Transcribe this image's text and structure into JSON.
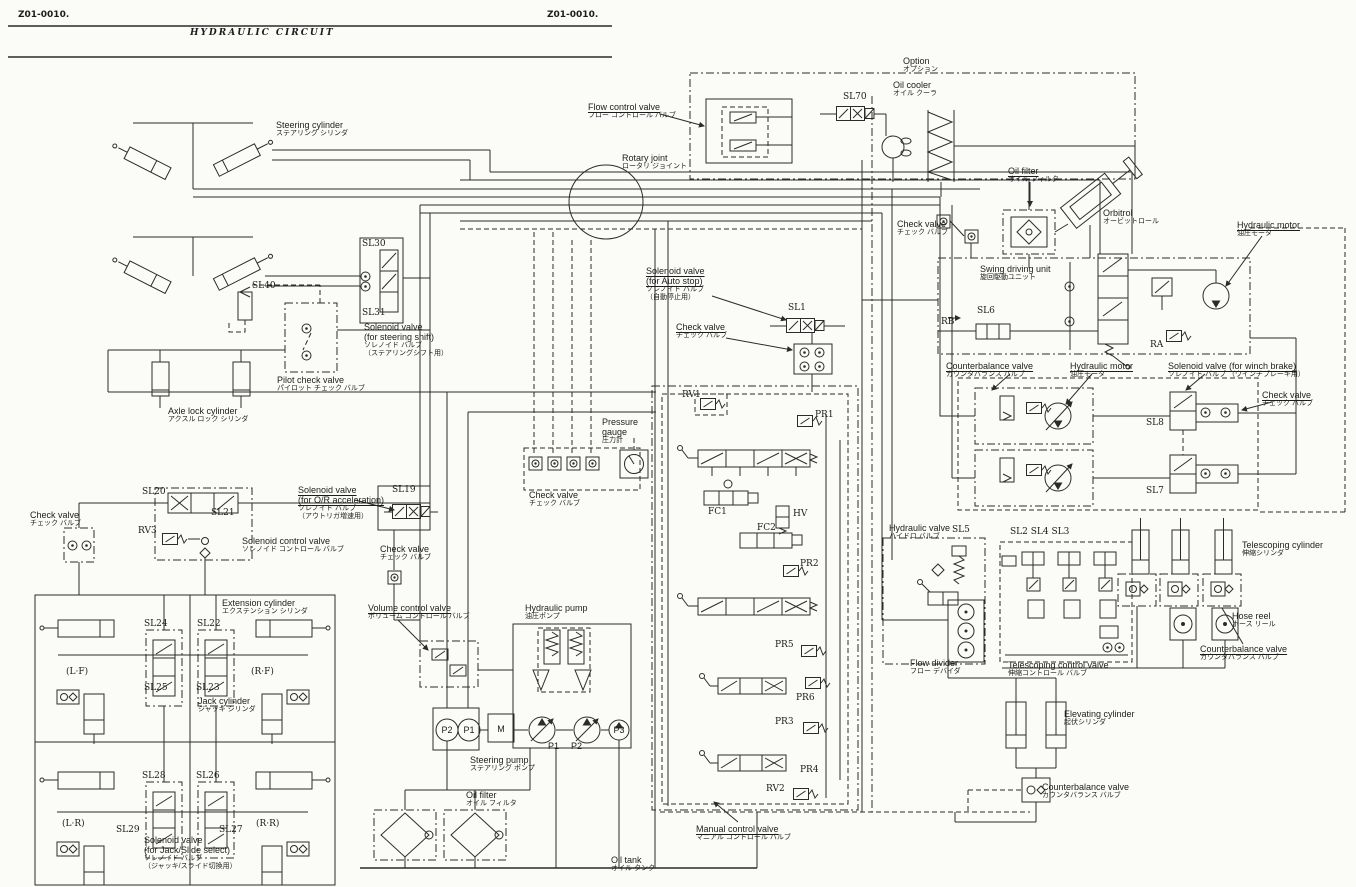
{
  "diagram": {
    "title": "HYDRAULIC  CIRCUIT",
    "doc_code": "Z01-0010."
  },
  "ink_color": "#2b2b2b",
  "paper_color": "#fbfbf8",
  "labels": [
    {
      "id": "doc-no-left",
      "en": "Z01-0010.",
      "x": 18,
      "y": 10,
      "cls": "docno"
    },
    {
      "id": "doc-no-right",
      "en": "Z01-0010.",
      "x": 547,
      "y": 10,
      "cls": "docno"
    },
    {
      "id": "page-title",
      "en": "HYDRAULIC  CIRCUIT",
      "x": 190,
      "y": 28,
      "cls": "title"
    },
    {
      "id": "steering-cylinder-label",
      "en": "Steering cylinder",
      "jp": "ステアリング シリンダ",
      "x": 276,
      "y": 120
    },
    {
      "id": "flow-control-valve-label",
      "en": "Flow control valve",
      "jp": "フロー コントロール バルブ",
      "x": 588,
      "y": 102,
      "u": 1
    },
    {
      "id": "rotary-joint-label",
      "en": "Rotary joint",
      "jp": "ロータリ ジョイント",
      "x": 622,
      "y": 153
    },
    {
      "id": "option-label",
      "en": "Option",
      "jp": "オプション",
      "x": 903,
      "y": 56
    },
    {
      "id": "oil-cooler-label",
      "en": "Oil cooler",
      "jp": "オイル クーラ",
      "x": 893,
      "y": 80
    },
    {
      "id": "sl70-label",
      "en": "SL70",
      "x": 843,
      "y": 92,
      "cls": "code"
    },
    {
      "id": "oil-filter-top-label",
      "en": "Oil filter",
      "jp": "オイル フィルタ",
      "x": 1008,
      "y": 166,
      "u": 1
    },
    {
      "id": "orbitrol-label",
      "en": "Orbitrol",
      "jp": "オービットロール",
      "x": 1103,
      "y": 208
    },
    {
      "id": "hydraulic-motor-top-label",
      "en": "Hydraulic motor",
      "jp": "油圧モータ",
      "x": 1237,
      "y": 220,
      "u": 1
    },
    {
      "id": "check-valve-top-label",
      "en": "Check valve",
      "jp": "チェック バルブ",
      "x": 897,
      "y": 219
    },
    {
      "id": "swing-driving-unit-label",
      "en": "Swing driving unit",
      "jp": "旋回駆動ユニット",
      "x": 980,
      "y": 264
    },
    {
      "id": "rb-label",
      "en": "RB",
      "x": 941,
      "y": 317,
      "cls": "code sm"
    },
    {
      "id": "sl6-label",
      "en": "SL6",
      "x": 977,
      "y": 306,
      "cls": "code"
    },
    {
      "id": "ra-label",
      "en": "RA",
      "x": 1150,
      "y": 340,
      "cls": "code sm"
    },
    {
      "id": "solenoid-auto-stop-label",
      "en": "Solenoid valve\n(for Auto stop)",
      "jp": "ソレノイド バルブ\n（自動停止用）",
      "x": 646,
      "y": 266,
      "u": 1
    },
    {
      "id": "check-valve-mid-label",
      "en": "Check valve",
      "jp": "チェック バルブ",
      "x": 676,
      "y": 322,
      "u": 1
    },
    {
      "id": "sl1-label",
      "en": "SL1",
      "x": 788,
      "y": 303,
      "cls": "code"
    },
    {
      "id": "counterbalance-top-label",
      "en": "Counterbalance valve",
      "jp": "カウンタバランス バルブ",
      "x": 946,
      "y": 361,
      "u": 1
    },
    {
      "id": "hydraulic-motor-mid-label",
      "en": "Hydraulic motor",
      "jp": "油圧モータ",
      "x": 1070,
      "y": 361,
      "u": 1
    },
    {
      "id": "solenoid-winch-label",
      "en": "Solenoid valve (for winch brake)",
      "jp": "ソレノイド バルブ （ウインチブレーキ用）",
      "x": 1168,
      "y": 361,
      "u": 1
    },
    {
      "id": "check-valve-right-label",
      "en": "Check valve",
      "jp": "チェック バルブ",
      "x": 1262,
      "y": 390,
      "u": 1
    },
    {
      "id": "sl8-label",
      "en": "SL8",
      "x": 1146,
      "y": 418,
      "cls": "code lg"
    },
    {
      "id": "sl7-label",
      "en": "SL7",
      "x": 1146,
      "y": 486,
      "cls": "code lg"
    },
    {
      "id": "sl30-label",
      "en": "SL30",
      "x": 362,
      "y": 239,
      "cls": "code"
    },
    {
      "id": "sl31-label",
      "en": "SL31",
      "x": 362,
      "y": 308,
      "cls": "code"
    },
    {
      "id": "solenoid-steering-shift-label",
      "en": "Solenoid valve\n(for steering shift)",
      "jp": "ソレノイド バルブ\n（ステアリングシフト用）",
      "x": 364,
      "y": 322
    },
    {
      "id": "sl40-label",
      "en": "SL40",
      "x": 252,
      "y": 281,
      "cls": "code"
    },
    {
      "id": "pilot-check-valve-label",
      "en": "Pilot check valve",
      "jp": "パイロット チェック バルブ",
      "x": 277,
      "y": 375
    },
    {
      "id": "axle-lock-cylinder-label",
      "en": "Axle lock cylinder",
      "jp": "アクスル ロック シリンダ",
      "x": 168,
      "y": 406
    },
    {
      "id": "check-valve-left-label",
      "en": "Check valve",
      "jp": "チェック バルブ",
      "x": 30,
      "y": 510
    },
    {
      "id": "sl20-label",
      "en": "SL20",
      "x": 142,
      "y": 487,
      "cls": "code"
    },
    {
      "id": "sl21-label",
      "en": "SL21",
      "x": 211,
      "y": 508,
      "cls": "code"
    },
    {
      "id": "rv3-label",
      "en": "RV3",
      "x": 138,
      "y": 526,
      "cls": "code"
    },
    {
      "id": "solenoid-control-valve-label",
      "en": "Solenoid control valve",
      "jp": "ソレノイド コントロール バルブ",
      "x": 242,
      "y": 536
    },
    {
      "id": "solenoid-or-accel-label",
      "en": "Solenoid valve\n(for O/R acceleration)",
      "jp": "ソレノイド バルブ\n（アウトリガ増速用）",
      "x": 298,
      "y": 485,
      "u": 1
    },
    {
      "id": "sl19-label",
      "en": "SL19",
      "x": 392,
      "y": 485,
      "cls": "code lg"
    },
    {
      "id": "check-valve-sl19-label",
      "en": "Check valve",
      "jp": "チェック バルブ",
      "x": 380,
      "y": 544
    },
    {
      "id": "extension-cylinder-label",
      "en": "Extension cylinder",
      "jp": "エクステンション シリンダ",
      "x": 222,
      "y": 598
    },
    {
      "id": "sl24-label",
      "en": "SL24",
      "x": 144,
      "y": 619,
      "cls": "code"
    },
    {
      "id": "sl22-label",
      "en": "SL22",
      "x": 197,
      "y": 619,
      "cls": "code"
    },
    {
      "id": "sl25-label",
      "en": "SL25",
      "x": 144,
      "y": 683,
      "cls": "code"
    },
    {
      "id": "sl23-label",
      "en": "SL23",
      "x": 196,
      "y": 683,
      "cls": "code"
    },
    {
      "id": "lf-label",
      "en": "(L·F)",
      "x": 66,
      "y": 667,
      "cls": "quad"
    },
    {
      "id": "rf-label",
      "en": "(R·F)",
      "x": 251,
      "y": 667,
      "cls": "quad"
    },
    {
      "id": "jack-cylinder-label",
      "en": "Jack cylinder",
      "jp": "ジャッキ シリンダ",
      "x": 198,
      "y": 696
    },
    {
      "id": "sl28-label",
      "en": "SL28",
      "x": 142,
      "y": 771,
      "cls": "code"
    },
    {
      "id": "sl26-label",
      "en": "SL26",
      "x": 196,
      "y": 771,
      "cls": "code"
    },
    {
      "id": "sl29-label",
      "en": "SL29",
      "x": 116,
      "y": 825,
      "cls": "code"
    },
    {
      "id": "sl27-label",
      "en": "SL27",
      "x": 219,
      "y": 825,
      "cls": "code"
    },
    {
      "id": "lr-label",
      "en": "(L·R)",
      "x": 62,
      "y": 819,
      "cls": "quad"
    },
    {
      "id": "rr-label",
      "en": "(R·R)",
      "x": 256,
      "y": 819,
      "cls": "quad"
    },
    {
      "id": "solenoid-jack-slide-label",
      "en": "Solenoid valve\n(for Jack/Slide select)",
      "jp": "ソレノイド バルブ\n（ジャッキ/スライド切換用）",
      "x": 144,
      "y": 835
    },
    {
      "id": "volume-control-valve-label",
      "en": "Volume control valve",
      "jp": "ボリューム コントロール バルブ",
      "x": 368,
      "y": 603,
      "u": 1
    },
    {
      "id": "hydraulic-pump-label",
      "en": "Hydraulic pump",
      "jp": "油圧ポンプ",
      "x": 525,
      "y": 603
    },
    {
      "id": "check-valve-gauge-label",
      "en": "Check valve",
      "jp": "チェック バルブ",
      "x": 529,
      "y": 490
    },
    {
      "id": "pressure-gauge-label",
      "en": "Pressure\ngauge",
      "jp": "圧力計",
      "x": 602,
      "y": 417
    },
    {
      "id": "steering-pump-label",
      "en": "Steering pump",
      "jp": "ステアリング ポンプ",
      "x": 470,
      "y": 755
    },
    {
      "id": "oil-filter-bottom-label",
      "en": "Oil filter",
      "jp": "オイル フィルタ",
      "x": 466,
      "y": 790
    },
    {
      "id": "oil-tank-label",
      "en": "Oil tank",
      "jp": "オイル タンク",
      "x": 611,
      "y": 855
    },
    {
      "id": "rv1-label",
      "en": "RV1",
      "x": 682,
      "y": 390,
      "cls": "code"
    },
    {
      "id": "pr1-label",
      "en": "PR1",
      "x": 815,
      "y": 410,
      "cls": "code"
    },
    {
      "id": "fc1-label",
      "en": "FC1",
      "x": 708,
      "y": 507,
      "cls": "code"
    },
    {
      "id": "hv-label",
      "en": "HV",
      "x": 793,
      "y": 509,
      "cls": "code"
    },
    {
      "id": "fc2-label",
      "en": "FC2",
      "x": 757,
      "y": 523,
      "cls": "code"
    },
    {
      "id": "pr2-label",
      "en": "PR2",
      "x": 800,
      "y": 559,
      "cls": "code"
    },
    {
      "id": "pr5-label",
      "en": "PR5",
      "x": 775,
      "y": 640,
      "cls": "code"
    },
    {
      "id": "pr6-label",
      "en": "PR6",
      "x": 796,
      "y": 693,
      "cls": "code"
    },
    {
      "id": "pr3-label",
      "en": "PR3",
      "x": 775,
      "y": 717,
      "cls": "code"
    },
    {
      "id": "pr4-label",
      "en": "PR4",
      "x": 800,
      "y": 765,
      "cls": "code"
    },
    {
      "id": "rv2-label",
      "en": "RV2",
      "x": 766,
      "y": 784,
      "cls": "code"
    },
    {
      "id": "manual-control-valve-label",
      "en": "Manual control valve",
      "jp": "マニアル コントロール バルブ",
      "x": 696,
      "y": 824,
      "u": 1
    },
    {
      "id": "flow-divider-label",
      "en": "Flow divider",
      "jp": "フロー デバイダ",
      "x": 910,
      "y": 658
    },
    {
      "id": "hydraulic-valve-label",
      "en": "Hydraulic valve",
      "jp": "ハイドロ バルブ",
      "x": 889,
      "y": 523
    },
    {
      "id": "sl5-label",
      "en": "SL5",
      "x": 952,
      "y": 525,
      "cls": "code lg"
    },
    {
      "id": "sl2-sl4-sl3-label",
      "en": "SL2 SL4 SL3",
      "x": 1010,
      "y": 527,
      "cls": "code lg"
    },
    {
      "id": "telescoping-control-valve-label",
      "en": "Telescoping control valve",
      "jp": "伸縮コントロール バルブ",
      "x": 1008,
      "y": 660
    },
    {
      "id": "telescoping-cylinder-label",
      "en": "Telescoping cylinder",
      "jp": "伸縮シリンダ",
      "x": 1242,
      "y": 540
    },
    {
      "id": "hose-reel-label",
      "en": "Hose reel",
      "jp": "ホース リール",
      "x": 1232,
      "y": 611
    },
    {
      "id": "counterbalance-right-label",
      "en": "Counterbalance valve",
      "jp": "カウンタバランス バルブ",
      "x": 1200,
      "y": 644,
      "u": 1
    },
    {
      "id": "elevating-cylinder-label",
      "en": "Elevating cylinder",
      "jp": "起伏シリンダ",
      "x": 1064,
      "y": 709
    },
    {
      "id": "counterbalance-bottom-label",
      "en": "Counterbalance valve",
      "jp": "カウンタバランス バルブ",
      "x": 1042,
      "y": 782
    },
    {
      "id": "p2-steering-label",
      "en": "P2",
      "x": 447,
      "y": 730,
      "cls": "cc port"
    },
    {
      "id": "p1-steering-label",
      "en": "P1",
      "x": 469,
      "y": 730,
      "cls": "cc port"
    },
    {
      "id": "m-label",
      "en": "M",
      "x": 501,
      "y": 729,
      "cls": "cc mlabel"
    },
    {
      "id": "p1-pump-label",
      "en": "P1",
      "x": 548,
      "y": 741,
      "cls": "port"
    },
    {
      "id": "p2-pump-label",
      "en": "P2",
      "x": 571,
      "y": 741,
      "cls": "port"
    },
    {
      "id": "p3-pump-label",
      "en": "P3",
      "x": 619,
      "y": 730,
      "cls": "cc port"
    }
  ]
}
